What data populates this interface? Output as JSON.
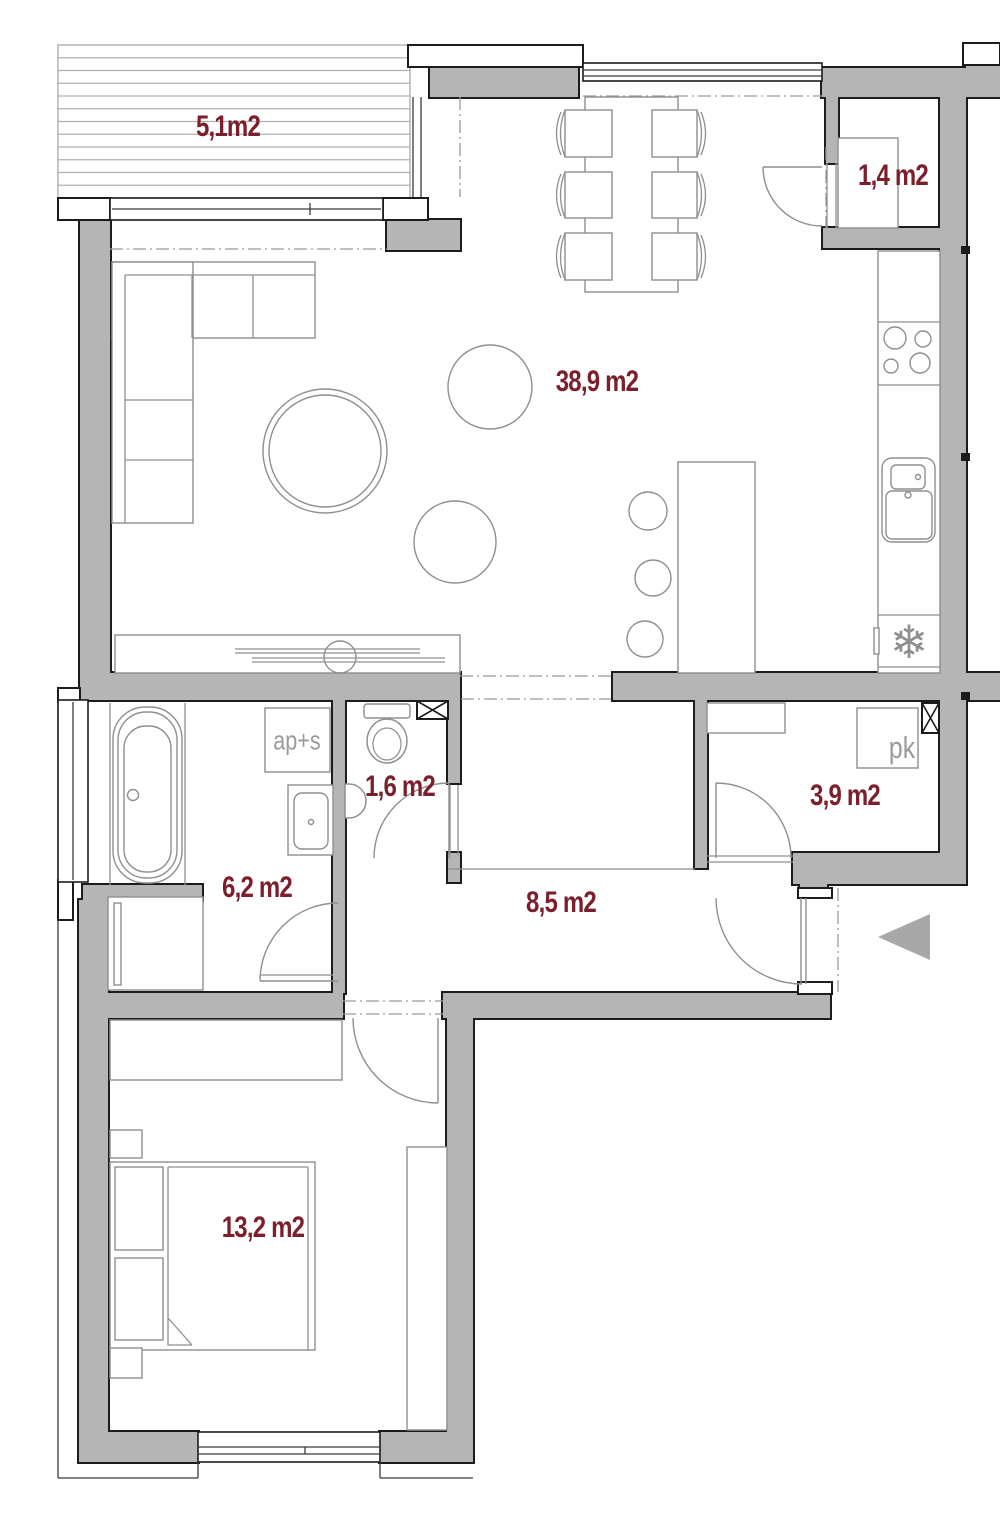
{
  "plan": {
    "kind": "apartment-floor-plan"
  },
  "rooms": {
    "terrace": {
      "area_label": "5,1m2"
    },
    "closet": {
      "area_label": "1,4 m2"
    },
    "living_kitchen": {
      "area_label": "38,9 m2"
    },
    "wc": {
      "area_label": "1,6 m2"
    },
    "storage": {
      "area_label": "3,9 m2"
    },
    "bathroom": {
      "area_label": "6,2 m2"
    },
    "hallway": {
      "area_label": "8,5 m2"
    },
    "bedroom": {
      "area_label": "13,2 m2"
    }
  },
  "fixtures": {
    "washer_dryer_label": "ap+s",
    "storage_cabinet_label": "pk",
    "fridge_snowflake_glyph": "❄",
    "vent_icon": "crossed-box",
    "entrance_icon": "left-triangle-arrow"
  },
  "colors": {
    "wall_fill": "#b5b5b5",
    "wall_outline": "#1c1c1c",
    "furniture_line": "#8f8f8f",
    "area_label": "#7a1f2b",
    "fixture_label": "#9a9a9a",
    "entrance_arrow": "#a8a8a8"
  }
}
